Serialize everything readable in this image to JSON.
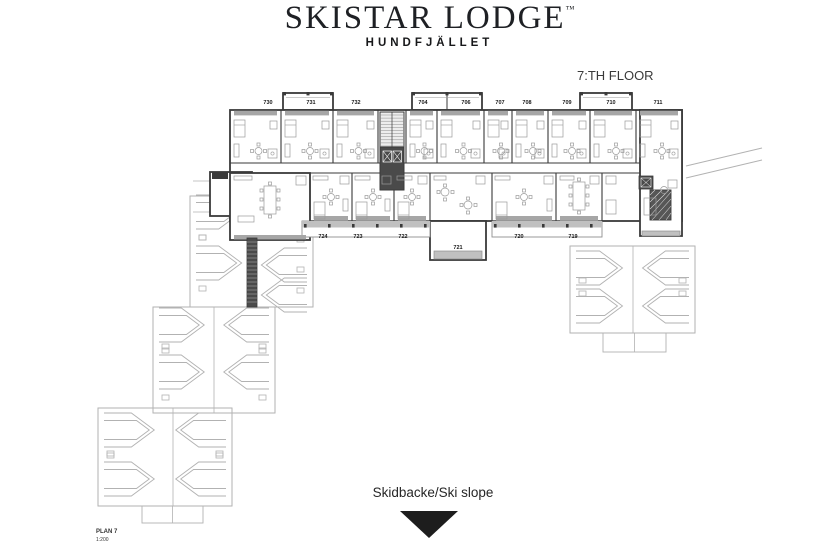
{
  "brand": {
    "title": "SKISTAR LODGE",
    "trademark": "™",
    "subtitle": "HUNDFJÄLLET"
  },
  "floor_label": "7:TH FLOOR",
  "slope_label": "Skidbacke/Ski slope",
  "plan_meta": {
    "name": "PLAN 7",
    "scale": "1:200"
  },
  "floor_plan": {
    "top_rooms": [
      "730",
      "731",
      "732",
      "704",
      "706",
      "707",
      "708",
      "709",
      "710",
      "711"
    ],
    "bottom_rooms": [
      "724",
      "723",
      "722",
      "721",
      "720",
      "719"
    ]
  },
  "colors": {
    "wall": "#3a3a3a",
    "roof_outline": "#b2b2b2",
    "balcony_fill": "#c0c0c0",
    "window_band": "#a6a6a6",
    "core_dark": "#4a4a4a",
    "furniture": "#9a9a9a",
    "label_text": "#1a1a1a",
    "triangle": "#1d1d1d",
    "background": "#ffffff"
  }
}
